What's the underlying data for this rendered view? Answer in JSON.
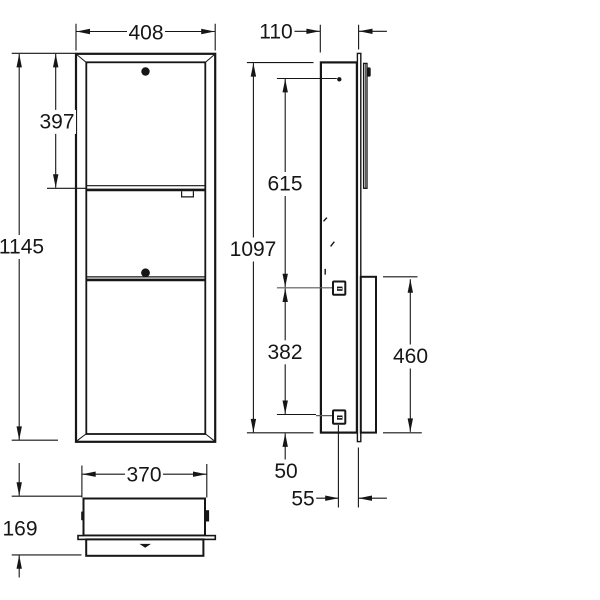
{
  "drawing_title": "recessed cabinet dimensional drawing",
  "colors": {
    "line": "#161616",
    "leader": "#5a5a5a",
    "background": "#ffffff"
  },
  "views": {
    "front": {
      "label": "front-view",
      "dimensions": {
        "width": "408",
        "upper_door_height": "397",
        "total_height": "1145"
      }
    },
    "side": {
      "label": "side-view",
      "dimensions": {
        "depth": "110",
        "upper_fixing_offset": "615",
        "body_height": "1097",
        "fixing_spacing": "382",
        "bin_box_height": "460",
        "bottom_fixing_offset": "50",
        "front_protrusion": "55"
      }
    },
    "bottom": {
      "label": "bottom-view",
      "dimensions": {
        "inner_width": "370",
        "total_depth": "169"
      }
    }
  }
}
